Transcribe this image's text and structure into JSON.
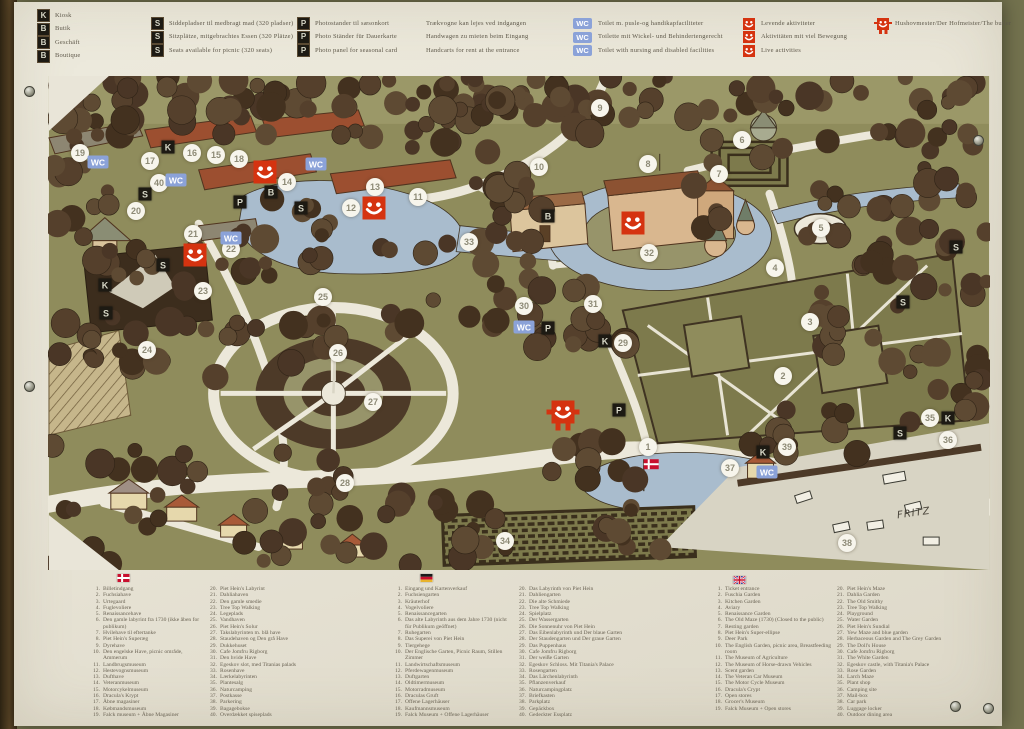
{
  "board": {
    "top_legend": {
      "shop": [
        {
          "icon": "K",
          "label": "Kiosk"
        },
        {
          "icon": "B",
          "label": "Butik"
        },
        {
          "icon": "B",
          "label": "Geschäft"
        },
        {
          "icon": "B",
          "label": "Boutique"
        }
      ],
      "seats": [
        {
          "icon": "S",
          "label": "Siddepladser til medbragt mad (320 pladser)"
        },
        {
          "icon": "S",
          "label": "Sitzplätze, mitgebrachtes Essen (320 Plätze)"
        },
        {
          "icon": "S",
          "label": "Seats available for picnic (320 seats)"
        }
      ],
      "photo": [
        {
          "icon": "P",
          "label": "Photostander til sæsonkort"
        },
        {
          "icon": "P",
          "label": "Photo Ständer für Dauerkarte"
        },
        {
          "icon": "P",
          "label": "Photo panel for seasonal card"
        }
      ],
      "handcarts": [
        "Trækvogne kan lejes ved indgangen",
        "Handwagen zu mieten beim Eingang",
        "Handcarts for rent at the entrance"
      ],
      "wc": [
        {
          "icon": "WC",
          "label": "Toilet m. pusle-og handikapfaciliteter"
        },
        {
          "icon": "WC",
          "label": "Toilette mit Wickel- und Behindertengerecht"
        },
        {
          "icon": "WC",
          "label": "Toilet with nursing and disabled facilities"
        }
      ],
      "activities": [
        {
          "icon": "smiley",
          "label": "Levende aktiviteter"
        },
        {
          "icon": "smiley",
          "label": "Aktivitäten mit viel Bewegung"
        },
        {
          "icon": "smiley",
          "label": "Live activities"
        }
      ],
      "butler": {
        "icon": "smiley-figure",
        "label": "Hushovmester/Der Hofmeister/The butler"
      }
    },
    "map": {
      "signature": "FRITZ",
      "markers": {
        "numbers": [
          {
            "n": "1",
            "x": 648,
            "y": 447
          },
          {
            "n": "2",
            "x": 783,
            "y": 376
          },
          {
            "n": "3",
            "x": 810,
            "y": 322
          },
          {
            "n": "4",
            "x": 775,
            "y": 268
          },
          {
            "n": "5",
            "x": 821,
            "y": 228
          },
          {
            "n": "6",
            "x": 742,
            "y": 140
          },
          {
            "n": "7",
            "x": 719,
            "y": 174
          },
          {
            "n": "8",
            "x": 648,
            "y": 164
          },
          {
            "n": "9",
            "x": 600,
            "y": 108
          },
          {
            "n": "10",
            "x": 539,
            "y": 167
          },
          {
            "n": "11",
            "x": 418,
            "y": 197
          },
          {
            "n": "12",
            "x": 351,
            "y": 208
          },
          {
            "n": "13",
            "x": 375,
            "y": 187
          },
          {
            "n": "14",
            "x": 287,
            "y": 182
          },
          {
            "n": "15",
            "x": 216,
            "y": 155
          },
          {
            "n": "16",
            "x": 192,
            "y": 153
          },
          {
            "n": "17",
            "x": 150,
            "y": 161
          },
          {
            "n": "18",
            "x": 239,
            "y": 159
          },
          {
            "n": "19",
            "x": 80,
            "y": 153
          },
          {
            "n": "20",
            "x": 136,
            "y": 211
          },
          {
            "n": "21",
            "x": 193,
            "y": 234
          },
          {
            "n": "22",
            "x": 231,
            "y": 249
          },
          {
            "n": "23",
            "x": 203,
            "y": 291
          },
          {
            "n": "24",
            "x": 147,
            "y": 350
          },
          {
            "n": "25",
            "x": 323,
            "y": 297
          },
          {
            "n": "26",
            "x": 338,
            "y": 353
          },
          {
            "n": "27",
            "x": 373,
            "y": 402
          },
          {
            "n": "28",
            "x": 345,
            "y": 483
          },
          {
            "n": "29",
            "x": 623,
            "y": 343
          },
          {
            "n": "30",
            "x": 524,
            "y": 306
          },
          {
            "n": "31",
            "x": 593,
            "y": 304
          },
          {
            "n": "32",
            "x": 649,
            "y": 253
          },
          {
            "n": "33",
            "x": 469,
            "y": 242
          },
          {
            "n": "34",
            "x": 505,
            "y": 541
          },
          {
            "n": "35",
            "x": 930,
            "y": 418
          },
          {
            "n": "36",
            "x": 948,
            "y": 440
          },
          {
            "n": "37",
            "x": 730,
            "y": 468
          },
          {
            "n": "38",
            "x": 847,
            "y": 543
          },
          {
            "n": "39",
            "x": 787,
            "y": 447
          },
          {
            "n": "40",
            "x": 159,
            "y": 183
          }
        ],
        "letters": [
          {
            "t": "K",
            "x": 168,
            "y": 147
          },
          {
            "t": "K",
            "x": 105,
            "y": 285
          },
          {
            "t": "K",
            "x": 605,
            "y": 341
          },
          {
            "t": "K",
            "x": 948,
            "y": 418
          },
          {
            "t": "K",
            "x": 763,
            "y": 452
          },
          {
            "t": "S",
            "x": 145,
            "y": 194
          },
          {
            "t": "S",
            "x": 301,
            "y": 208
          },
          {
            "t": "S",
            "x": 163,
            "y": 265
          },
          {
            "t": "S",
            "x": 106,
            "y": 313
          },
          {
            "t": "S",
            "x": 956,
            "y": 247
          },
          {
            "t": "S",
            "x": 903,
            "y": 302
          },
          {
            "t": "S",
            "x": 900,
            "y": 433
          },
          {
            "t": "B",
            "x": 271,
            "y": 192
          },
          {
            "t": "B",
            "x": 548,
            "y": 216
          },
          {
            "t": "P",
            "x": 240,
            "y": 202
          },
          {
            "t": "P",
            "x": 548,
            "y": 328
          },
          {
            "t": "P",
            "x": 619,
            "y": 410
          }
        ],
        "wc": [
          {
            "x": 98,
            "y": 162
          },
          {
            "x": 176,
            "y": 180
          },
          {
            "x": 316,
            "y": 164
          },
          {
            "x": 231,
            "y": 238
          },
          {
            "x": 524,
            "y": 327
          },
          {
            "x": 767,
            "y": 472
          }
        ],
        "smileys": [
          {
            "x": 265,
            "y": 172
          },
          {
            "x": 374,
            "y": 208
          },
          {
            "x": 633,
            "y": 223
          },
          {
            "x": 195,
            "y": 255
          },
          {
            "x": 563,
            "y": 412,
            "figure": true
          }
        ]
      }
    },
    "bottom_legend": {
      "danish": {
        "items_1_19": [
          "Billetindgang",
          "Fuchsiahave",
          "Urtegaard",
          "Fuglevoliere",
          "Renaissancehave",
          "Den gamle labyrint fra 1730 (ikke åben for publikum)",
          "Hvilehave til eftertanke",
          "Piet Hein's Superæg",
          "Dyrehave",
          "Den engelske Have, picnic område, Ammerum",
          "Landbrugsmuseum",
          "Hestevognsmuseum",
          "Dufthave",
          "Veteranmuseum",
          "Motorcykelmuseum",
          "Dracula's Krypt",
          "Åbne magasiner",
          "Købmandsmuseum",
          "Falck museum + Åbne Magasiner"
        ],
        "items_20_40": [
          "Piet Hein's Labyrint",
          "Dahliahaven",
          "Den gamle smedie",
          "Tree Top Walking",
          "Legeplads",
          "Vandhaven",
          "Piet Hein's Solur",
          "Takslabyrinten m. blå have",
          "Staudehaven og Den grå Have",
          "Dukkehuset",
          "Cafe Jomfru Rigborg",
          "Den hvide Have",
          "Egeskov slot, med Titanias palads",
          "Rosenhave",
          "Lærkelabyrinten",
          "Plantesalg",
          "Naturcamping",
          "Postkasse",
          "Parkering",
          "Bagagebokse",
          "Overdækket spiseplads"
        ]
      },
      "german": {
        "items_1_19": [
          "Eingang und Kartenverkauf",
          "Fuchsiengarten",
          "Kräuterhof",
          "Vogelvoliere",
          "Renaissancegarten",
          "Das alte Labyrinth aus dem Jahre 1730 (nicht für Publikum geöffnet)",
          "Ruhegarten",
          "Das Superei von Piet Hein",
          "Tiergehege",
          "Der Englische Garten, Picnic Raum, Stillen Zimmer",
          "Landwirtschaftsmuseum",
          "Pferdewagenmuseum",
          "Duftgarten",
          "Oldtimermuseum",
          "Motorradmuseum",
          "Draculas Gruft",
          "Offene Lagerhäuser",
          "Kaufmannsmuseum",
          "Falck Museum + Offene Lagerhäuser"
        ],
        "items_20_40": [
          "Das Labyrinth von Piet Hein",
          "Dahliengarten",
          "Die alte Schmiede",
          "Tree Top Walking",
          "Spielplatz",
          "Der Wassergarten",
          "Die Sonnenuhr von Piet Hein",
          "Das Eibenlabyrinth und Der blaue Garten",
          "Der Staudengarten und Der graue Garten",
          "Das Puppenhaus",
          "Cafe Jomfru Rigborg",
          "Der weiße Garten",
          "Egeskov Schloss. Mit Titania's Palace",
          "Rosengarten",
          "Das Lärchenlabyrinth",
          "Pflanzenverkauf",
          "Naturcampingplatz",
          "Briefkasten",
          "Parkplatz",
          "Gepäckbox",
          "Gedeckter Essplatz"
        ]
      },
      "english": {
        "items_1_19": [
          "Ticket entrance",
          "Fuschia Garden",
          "Kitchen Garden",
          "Aviary",
          "Renaissance Garden",
          "The Old Maze (1730) (Closed to the public)",
          "Resting garden",
          "Piet Hein's Super-ellipse",
          "Deer Park",
          "The English Garden, picnic area, Breastfeeding room",
          "The Museum of Agriculture",
          "The Museum of Horse-drawn Vehicles",
          "Scent garden",
          "The Veteran Car Museum",
          "The Motor Cycle Museum",
          "Dracula's Crypt",
          "Open stores",
          "Grocer's Museum",
          "Falck Museum + Open stores"
        ],
        "items_20_40": [
          "Piet Hein's Maze",
          "Dahlia Garden",
          "The Old Smithy",
          "Tree Top Walking",
          "Playground",
          "Water Garden",
          "Piet Hein's Sundial",
          "Yew Maze and blue garden",
          "Herbaceous Garden and The Grey Garden",
          "The Doll's House",
          "Cafe Jomfru Rigborg",
          "The White Garden",
          "Egeskov castle, with Titania's Palace",
          "Rose Garden",
          "Larch Maze",
          "Plant shop",
          "Camping site",
          "Mail-box",
          "Car park",
          "Luggage locker",
          "Outdoor dining area"
        ]
      }
    },
    "colors": {
      "smiley_red": "#d53310",
      "wc_blue": "#8ba2d8",
      "badge_black": "#1d1a13",
      "lawn_green": "#8f8c5c",
      "tree_brown": "#4a3626",
      "water_blue": "#a9bccd"
    }
  }
}
